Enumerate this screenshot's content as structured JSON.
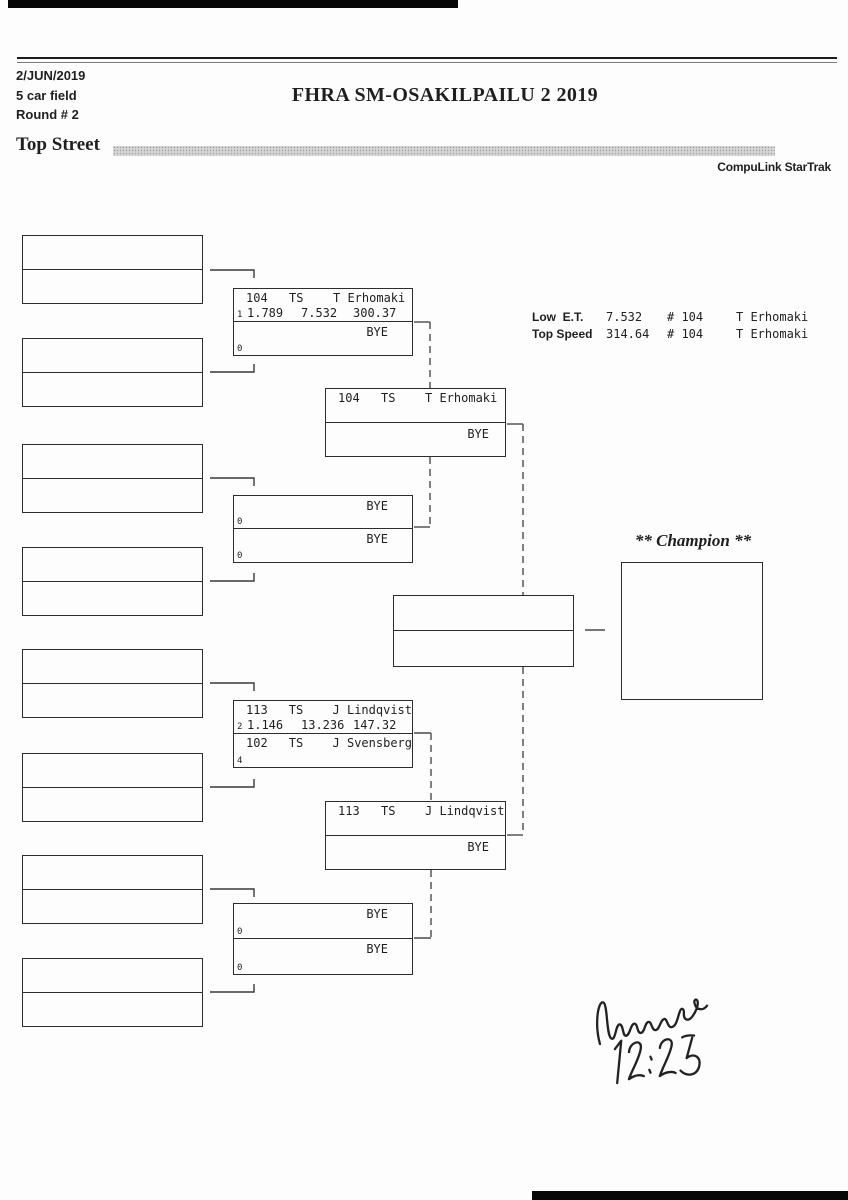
{
  "colors": {
    "ink": "#1f1f1f",
    "line": "#2d2d2d"
  },
  "header": {
    "date": "2/JUN/2019",
    "field_size": "5 car field",
    "round": "Round # 2",
    "title": "FHRA SM-OSAKILPAILU 2 2019",
    "class_name": "Top Street",
    "brand": "CompuLink StarTrak"
  },
  "stats": {
    "low_et_label": "Low  E.T.",
    "low_et_value": "7.532",
    "low_et_car": "# 104",
    "low_et_driver": "T Erhomaki",
    "top_speed_label": "Top Speed",
    "top_speed_value": "314.64",
    "top_speed_car": "# 104",
    "top_speed_driver": "T Erhomaki"
  },
  "bracket": {
    "round1_slots": 8,
    "r2": [
      {
        "top": {
          "car": "104",
          "cls": "TS",
          "driver": "T Erhomaki"
        },
        "top_seed": "1",
        "top_sixty": "1.789",
        "top_et": "7.532",
        "top_speed": "300.37",
        "bottom_bye": "BYE",
        "bottom_seed": "0"
      },
      {
        "top_bye": "BYE",
        "top_seed": "0",
        "bottom_bye": "BYE",
        "bottom_seed": "0"
      },
      {
        "top": {
          "car": "113",
          "cls": "TS",
          "driver": "J Lindqvist"
        },
        "top_seed": "2",
        "top_sixty": "1.146",
        "top_et": "13.236",
        "top_speed": "147.32",
        "bottom": {
          "car": "102",
          "cls": "TS",
          "driver": "J Svensberg"
        },
        "bottom_seed": "4"
      },
      {
        "top_bye": "BYE",
        "top_seed": "0",
        "bottom_bye": "BYE",
        "bottom_seed": "0"
      }
    ],
    "semi": [
      {
        "car": "104",
        "cls": "TS",
        "driver": "T Erhomaki",
        "bye": "BYE"
      },
      {
        "car": "113",
        "cls": "TS",
        "driver": "J Lindqvist",
        "bye": "BYE"
      }
    ],
    "champion_label": "** Champion **"
  },
  "handwriting": {
    "signature": "Monica",
    "time": "12:25"
  }
}
